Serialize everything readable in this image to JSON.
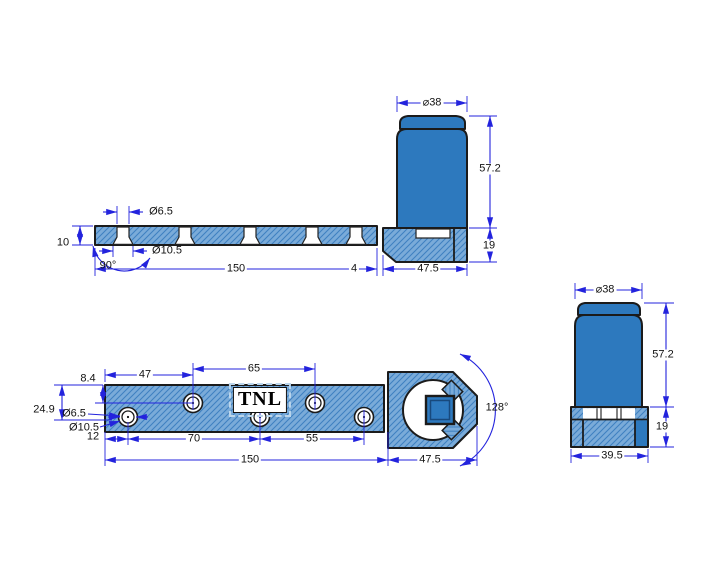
{
  "brand": {
    "logo_text": "TNL"
  },
  "colors": {
    "solid_fill": "#2d79be",
    "hatch_background": "#7aabd9",
    "hatch_line": "#3f81c1",
    "outline": "#1b1b1b",
    "dimension_blue": "#2323dd",
    "dimension_text": "#121212",
    "background": "#ffffff"
  },
  "views": {
    "side": {
      "dia38": "⌀38",
      "h572": "57.2",
      "h19": "19",
      "w475": "47.5",
      "len150": "150",
      "gap4": "4",
      "thk10": "10",
      "dia65": "Ø6.5",
      "dia105": "Ø10.5",
      "csk90": "90°"
    },
    "plan": {
      "e84": "8.4",
      "c47": "47",
      "c65": "65",
      "w249": "24.9",
      "dia65": "Ø6.5",
      "dia105": "Ø10.5",
      "c12": "12",
      "c70": "70",
      "c55": "55",
      "len150": "150",
      "head475": "47.5",
      "ang128": "128°"
    },
    "front": {
      "dia38": "⌀38",
      "h572": "57.2",
      "h19": "19",
      "w395": "39.5"
    }
  }
}
